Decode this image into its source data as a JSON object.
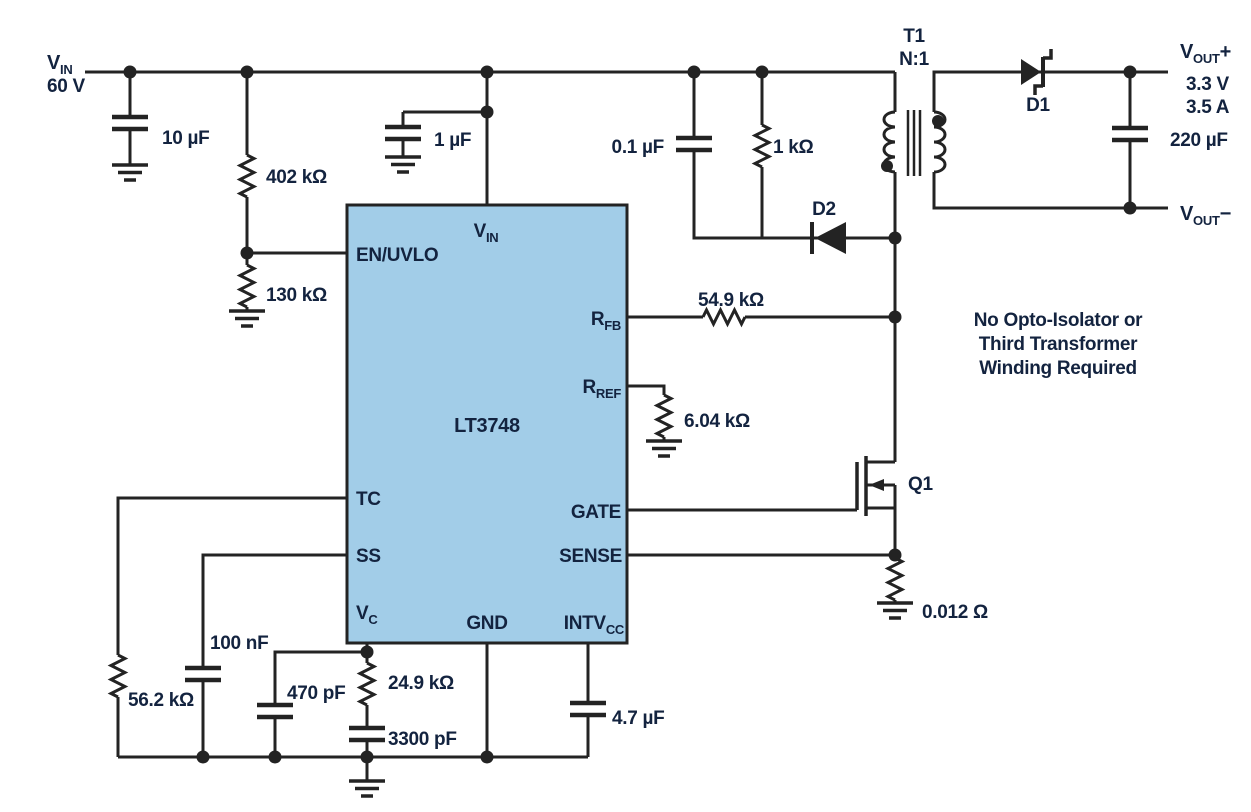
{
  "colors": {
    "wire": "#232323",
    "label_text": "#13233f",
    "ic_fill": "#a2cde8",
    "note_green": "#1aa66c",
    "background": "#ffffff"
  },
  "input": {
    "v": "V",
    "v_sub": "IN",
    "voltage": "60 V"
  },
  "ic": {
    "part": "LT3748",
    "pin_en_uvlo": "EN/UVLO",
    "pin_vin": "V",
    "pin_vin_sub": "IN",
    "pin_rfb": "R",
    "pin_rfb_sub": "FB",
    "pin_rref": "R",
    "pin_rref_sub": "REF",
    "pin_tc": "TC",
    "pin_ss": "SS",
    "pin_vc": "V",
    "pin_vc_sub": "C",
    "pin_gnd": "GND",
    "pin_intvcc": "INTV",
    "pin_intvcc_sub": "CC",
    "pin_gate": "GATE",
    "pin_sense": "SENSE"
  },
  "parts": {
    "c_in": "10 µF",
    "r_uvlo_top": "402 kΩ",
    "r_uvlo_bottom": "130 kΩ",
    "c_vin": "1 µF",
    "c_snubber": "0.1 µF",
    "r_snubber": "1 kΩ",
    "d2": "D2",
    "t1": "T1",
    "t1_ratio": "N:1",
    "d1": "D1",
    "c_out": "220 µF",
    "r_fb": "54.9 kΩ",
    "r_ref": "6.04 kΩ",
    "q1": "Q1",
    "r_sense": "0.012 Ω",
    "r_tc": "56.2 kΩ",
    "c_ss": "100 nF",
    "c_vc_hf": "470 pF",
    "r_vc": "24.9 kΩ",
    "c_vc": "3300 pF",
    "c_intvcc": "4.7 µF"
  },
  "output": {
    "v": "V",
    "v_sub": "OUT",
    "plus": "+",
    "minus": "−",
    "voltage": "3.3 V",
    "current": "3.5 A"
  },
  "note": {
    "line1": "No Opto-Isolator or",
    "line2": "Third Transformer",
    "line3": "Winding Required"
  }
}
